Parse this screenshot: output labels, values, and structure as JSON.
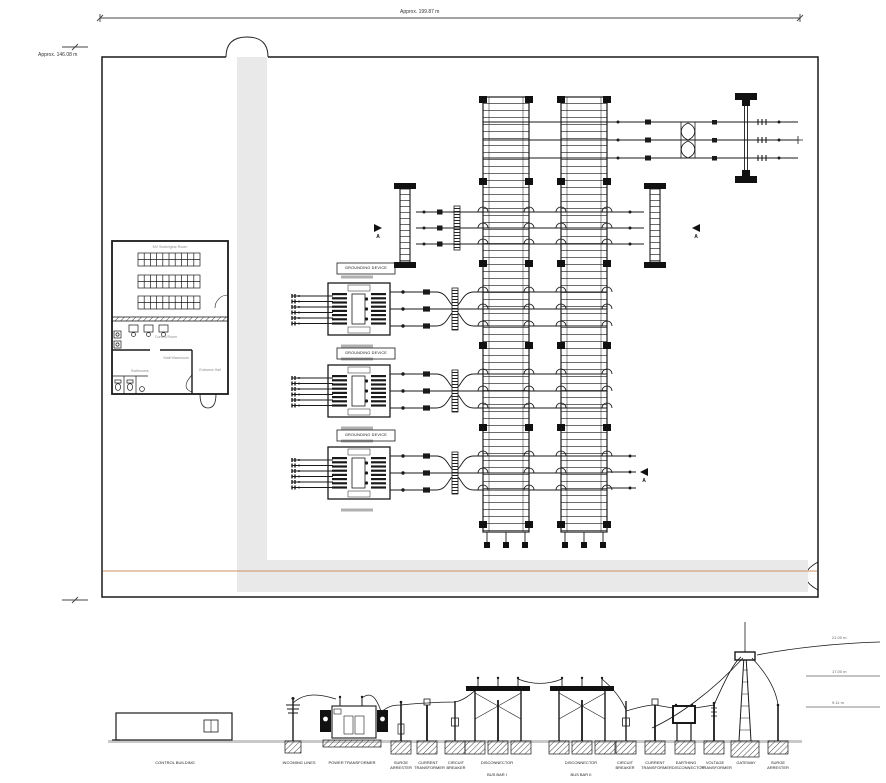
{
  "plan": {
    "dimension_top": "Approx. 199.87 m",
    "dimension_left": "Approx. 146.08 m",
    "grounding_device_label": "GROUNDING DEVICE",
    "section_marker": "A",
    "building": {
      "switchgear_room": "MV Switchgear Room",
      "control_room": "Control Room",
      "staff_washroom": "Staff Washroom",
      "bathrooms": "Bathrooms",
      "entrance_hall": "Entrance Hall"
    }
  },
  "elevation": {
    "equipment": [
      {
        "label": "CONTROL BUILDING"
      },
      {
        "label": "INCOMING LINES"
      },
      {
        "label": "POWER TRANSFORMER"
      },
      {
        "label": "SURGE ARRESTER"
      },
      {
        "label": "CURRENT TRANSFORMER"
      },
      {
        "label": "CIRCUIT BREAKER"
      },
      {
        "label": "DISCONNECTOR",
        "sub": "BUS BAR I"
      },
      {
        "label": "DISCONNECTOR",
        "sub": "BUS BAR II"
      },
      {
        "label": "CIRCUIT BREAKER"
      },
      {
        "label": "CURRENT TRANSFORMER"
      },
      {
        "label": "EARTHING DISCONNECTOR"
      },
      {
        "label": "VOLTAGE TRANSFORMER"
      },
      {
        "label": "GATEWAY"
      },
      {
        "label": "SURGE ARRESTER"
      }
    ],
    "levels": [
      {
        "label": "21.00 m"
      },
      {
        "label": "17.00 m"
      },
      {
        "label": "9.11 m"
      }
    ]
  },
  "colors": {
    "linework": "#1a1a1a",
    "road_fill": "#e9e9e9",
    "boundary_accent": "#c89064",
    "ground_fill": "#c9c9c9"
  }
}
